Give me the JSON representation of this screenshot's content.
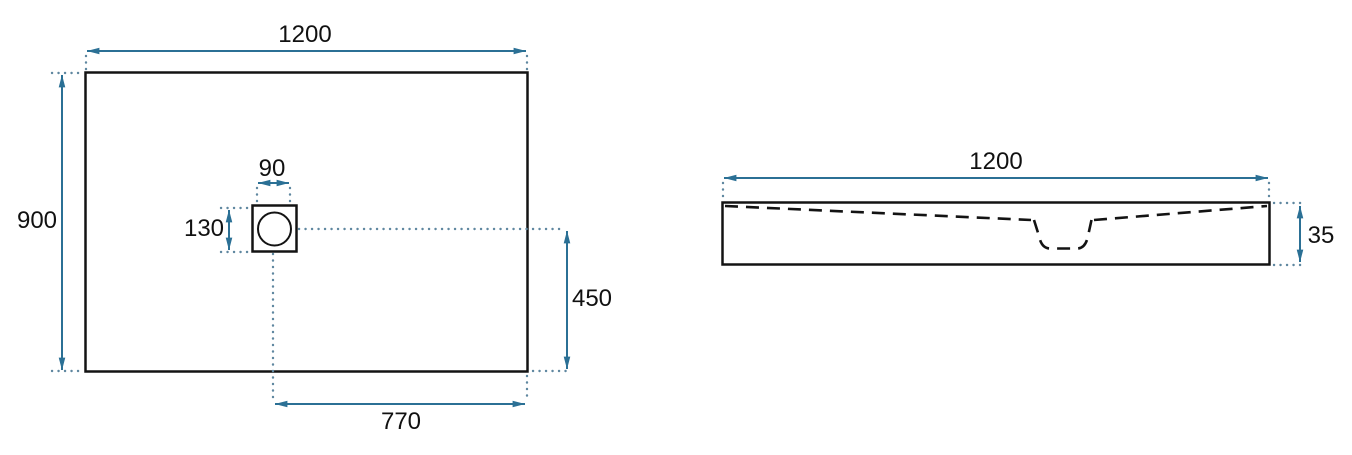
{
  "colors": {
    "accent": "#2b7095",
    "dots": "#5f87a0",
    "line": "#131313",
    "background": "#ffffff"
  },
  "views": {
    "top_view": {
      "dims": {
        "width": "1200",
        "height": "900",
        "drain_width": "90",
        "drain_height": "130",
        "drain_axis_to_bottom": "450",
        "drain_axis_to_right": "770"
      }
    },
    "side_view": {
      "dims": {
        "width": "1200",
        "thickness": "35"
      }
    }
  }
}
